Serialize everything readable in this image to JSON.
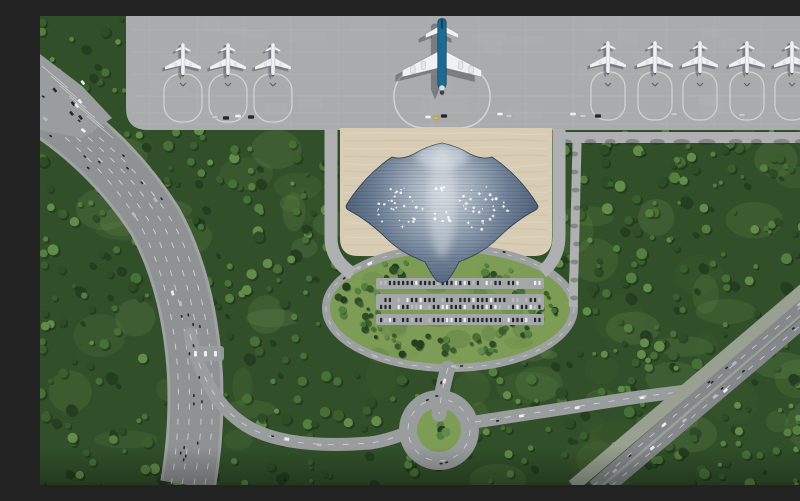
{
  "image": {
    "width": 800,
    "height": 469,
    "type": "architectural-aerial-render",
    "description": "Aerial rendering of a manta-ray-shaped airport terminal: grey apron with nine parked white jets and one blue widebody, beige forecourt plaza, dark-blue terminal roof with white star skylights and tapering tail, landscaped oval with parking rows, curved multi-lane highway at left, diagonal highway at lower right, roundabout at bottom, dense forest all around."
  },
  "seed": 7,
  "palette": {
    "forest_base": "#31502a",
    "forest": [
      "#243f1f",
      "#2e4d26",
      "#3a5e2e",
      "#477036",
      "#54803f",
      "#618c49"
    ],
    "grass": [
      "#5d8040",
      "#6d9350",
      "#49662f",
      "#7a9c58"
    ],
    "lawn": "#7d9c56",
    "apron": "#a9abac",
    "apron_joint": "#bcbebf",
    "apron_patch": "#b6b8b9",
    "stand_line": "#d2d4d5",
    "plaza": "#d8ccb4",
    "plaza_wave_dark": "#c9ba9d",
    "plaza_wave_light": "#e6dcc8",
    "roof_stops": [
      [
        "0",
        "#ced6dd"
      ],
      [
        "0.22",
        "#a9b5c2"
      ],
      [
        "0.5",
        "#6f8197"
      ],
      [
        "0.75",
        "#4e6076"
      ],
      [
        "1",
        "#3b4b5f"
      ]
    ],
    "roof_edge": "#2e3d4f",
    "roof_panel": "rgba(20,30,45,0.16)",
    "skylight": "#ffffff",
    "road": "#9a9d9e",
    "road_light": "#aeb0b1",
    "highway": "#8f9293",
    "highway_edge": "#a0a3a4",
    "lane": "#e6e8e9",
    "diagonal": "#84888a",
    "median_strip": "#9aa09a",
    "pale_track": "#98a091",
    "ring": "#9da1a1",
    "parking_pad": "#a4a7a7",
    "car_dark": "#23282e",
    "car_white": "#eceff1",
    "car_gray": "#b8bcbf",
    "marker_red": "#c23a2e",
    "vehicle_yellow": "#d9b73a",
    "fuselage": "#1d6a94",
    "fin": "#10425e",
    "plane_white": "#eff1f3",
    "engine": "#e4e7e9",
    "nose_dark": "#39414b",
    "shadow": "rgba(30,40,52,0.35)",
    "tree_shadow": "rgba(15,25,12,0.35)"
  },
  "apron": {
    "x": 86,
    "y": 0,
    "w": 714,
    "h": 114,
    "corner": 22,
    "joint_ys": [
      14,
      36,
      58,
      80,
      97,
      108
    ],
    "chevron_y": 67
  },
  "aircraft": {
    "left": [
      {
        "x": 143,
        "y": 44
      },
      {
        "x": 188,
        "y": 44
      },
      {
        "x": 233,
        "y": 44
      }
    ],
    "right": [
      {
        "x": 568,
        "y": 42
      },
      {
        "x": 615,
        "y": 42
      },
      {
        "x": 660,
        "y": 42
      },
      {
        "x": 707,
        "y": 42
      },
      {
        "x": 752,
        "y": 42
      }
    ],
    "widebody": {
      "x": 402,
      "y": 40,
      "scale": 2.2
    }
  },
  "red_markers": {
    "y": 118,
    "step": 12,
    "groups": [
      [
        332,
        404
      ],
      [
        440,
        512
      ]
    ]
  },
  "service_vehicles": [
    [
      175,
      101,
      "#c7cacc"
    ],
    [
      186,
      102,
      "#23282e"
    ],
    [
      198,
      100,
      "#eceff1"
    ],
    [
      211,
      101,
      "#23282e"
    ],
    [
      388,
      101,
      "#eceff1"
    ],
    [
      396,
      102,
      "#d9b73a"
    ],
    [
      404,
      100,
      "#23282e"
    ],
    [
      460,
      98,
      "#eceff1"
    ],
    [
      469,
      100,
      "#c7cacc"
    ],
    [
      533,
      98,
      "#eceff1"
    ],
    [
      543,
      100,
      "#c7cacc"
    ],
    [
      558,
      100,
      "#23282e"
    ],
    [
      634,
      98,
      "#c7cacc"
    ],
    [
      702,
      99,
      "#c7cacc"
    ]
  ],
  "plaza": {
    "x": 300,
    "y": 112,
    "w": 212,
    "h": 128,
    "waves": 16
  },
  "terminal": {
    "path": "M402,127 C412,129 422,133 430,138 C438,142 446,143 452,141 C470,153 486,170 497,188 C499,191 498,193 494,195 C482,201 468,212 458,222 C450,230 440,237 428,242 C424,244 421,245 419,246 C415,254 412,259 408,264 C406,267 398,267 396,264 C392,259 389,254 385,246 C383,245 380,244 376,242 C364,237 354,230 346,222 C336,212 322,201 310,195 C306,193 305,191 307,188 C318,170 334,153 352,141 C358,143 366,142 374,138 C382,133 392,129 402,127 Z",
    "panel_y1": 130,
    "panel_y2": 266,
    "panel_step": 3.5,
    "skylight_clusters": [
      {
        "cx": 362,
        "cy": 192,
        "rx": 26,
        "ry": 22,
        "n": 30
      },
      {
        "cx": 443,
        "cy": 192,
        "rx": 26,
        "ry": 22,
        "n": 30
      },
      {
        "cx": 402,
        "cy": 196,
        "rx": 9,
        "ry": 34,
        "n": 12
      }
    ]
  },
  "oval": {
    "cx": 410,
    "cy": 292,
    "rx": 124,
    "ry": 60,
    "ring_w": 8,
    "parking_pads": [
      [
        336,
        262,
        168,
        11
      ],
      [
        336,
        278,
        168,
        16
      ],
      [
        336,
        298,
        168,
        11
      ]
    ],
    "car_rows": [
      {
        "x1": 340,
        "x2": 500,
        "y": 267,
        "step": 4.4
      },
      {
        "x1": 340,
        "x2": 500,
        "y": 284,
        "step": 4.4
      },
      {
        "x1": 340,
        "x2": 500,
        "y": 291,
        "step": 4.4
      },
      {
        "x1": 340,
        "x2": 500,
        "y": 304,
        "step": 4.4
      }
    ],
    "occupancy": 0.85,
    "tree_clusters": [
      {
        "cx": 318,
        "cy": 286,
        "sx": 22,
        "sy": 16,
        "n": 16
      },
      {
        "cx": 498,
        "cy": 290,
        "sx": 24,
        "sy": 16,
        "n": 16
      },
      {
        "cx": 357,
        "cy": 254,
        "sx": 14,
        "sy": 8,
        "n": 8
      },
      {
        "cx": 458,
        "cy": 254,
        "sx": 14,
        "sy": 8,
        "n": 8
      },
      {
        "cx": 404,
        "cy": 330,
        "sx": 55,
        "sy": 10,
        "n": 22
      },
      {
        "cx": 340,
        "cy": 315,
        "sx": 18,
        "sy": 8,
        "n": 8
      },
      {
        "cx": 476,
        "cy": 316,
        "sx": 18,
        "sy": 8,
        "n": 8
      }
    ],
    "ring_cars": 8
  },
  "roads": {
    "highway": {
      "d": "M-20,80 C30,105 80,150 115,205 C140,250 152,305 155,360 C157,410 152,445 148,469",
      "w": 50,
      "edge_w": 56,
      "lanes": [
        -17,
        -6,
        6,
        17
      ],
      "vehicles": 30
    },
    "ramp": {
      "d": "M150,318 C160,360 178,395 212,413 C245,430 292,430 330,427 C345,425 356,421 366,417",
      "w": 13,
      "vehicles": 4
    },
    "north": {
      "d": "M408,352 C404,365 401,380 399,398",
      "w": 15,
      "vehicles": 2
    },
    "east": {
      "d": "M435,406 C480,399 535,391 585,383 C612,379 640,376 663,373",
      "w": 13,
      "vehicles": 5
    },
    "diagonal": {
      "a": "M553,470 L800,257",
      "b": "M571,470 L800,276",
      "median": "M562,470 L800,266",
      "pale": "M533,470 L800,243",
      "w": 11,
      "vehicles_each": 8
    },
    "top_right": {
      "x": 516,
      "y": 116,
      "w": 284,
      "h": 11,
      "shadow_step": 24
    },
    "right_vertical": {
      "d": "M537,127 C536,180 535,220 534,255 C533,272 534,284 533,291",
      "w": 9,
      "shadow_step": 18
    },
    "plaza_left": {
      "d": "M291,113 L291,222 C291,238 300,250 313,258",
      "w": 13
    },
    "plaza_right": {
      "d": "M519,113 L519,220 C519,236 512,248 502,256",
      "w": 13
    },
    "roundabout": {
      "cx": 399,
      "cy": 414,
      "r_outer": 40,
      "r_lane": 31,
      "r_island": 22,
      "island_trees": 5,
      "vehicles": 4
    },
    "layby": {
      "x": 150,
      "y": 330,
      "w": 34,
      "h": 15,
      "cars": 3
    }
  },
  "top_left_lot": {
    "poly": "M0,38 L42,70 L72,102 L42,122 L0,114 Z",
    "stripes": 6,
    "cars": 7
  },
  "forest": {
    "trees": 950,
    "patches": 90
  },
  "vignette_opacity": 0.28
}
